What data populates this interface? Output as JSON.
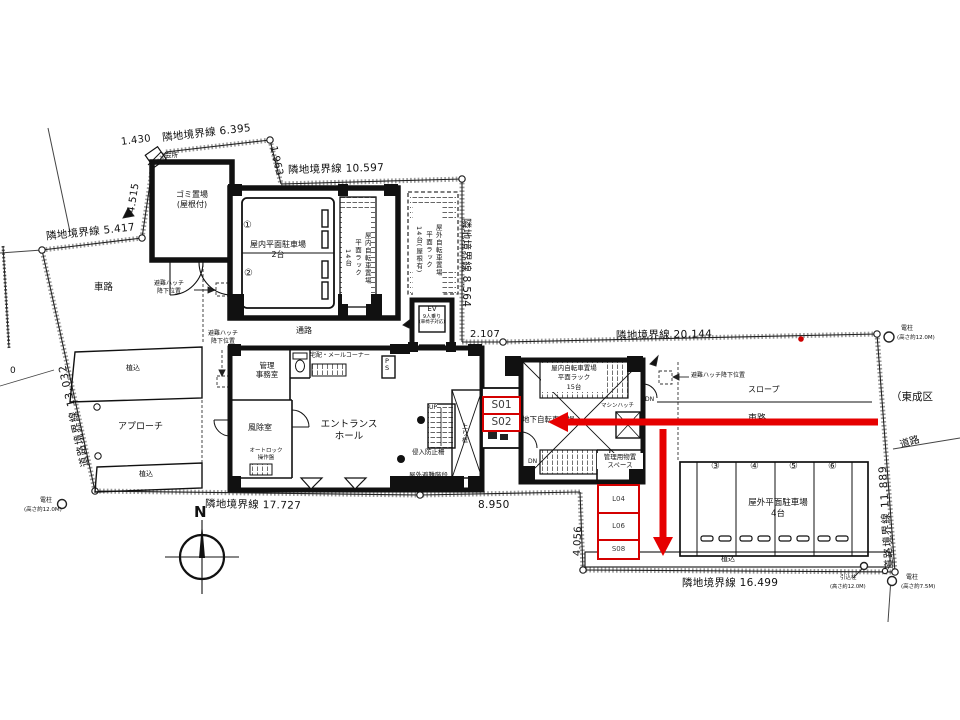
{
  "colors": {
    "red_arrow": "#e60000",
    "red_box": "#d40000",
    "ink": "#111111",
    "box_text": "#3a3a3a"
  },
  "boundary": {
    "b6395": "隣地境界線 6.395",
    "d1430": "1.430",
    "d1963": "1.963",
    "b10597": "隣地境界線 10.597",
    "b8564": "隣地境界線 8.564",
    "d2107": "2.107",
    "b20144": "隣地境界線 20.144",
    "b11889": "道路境界線 11.889",
    "b16499": "隣地境界線 16.499",
    "d4056": "4.056",
    "d8950": "8.950",
    "b17727": "隣地境界線 17.727",
    "b13032": "道路境界線 13.032",
    "b5417": "隣地境界線 5.417",
    "d4515": "4.515",
    "d0": "0"
  },
  "site": {
    "kaisho": "会所",
    "gomi1": "ゴミ置場",
    "gomi2": "(屋根付)",
    "sharo": "車路",
    "uekomi": "植込",
    "approach": "アプローチ",
    "tsuro": "通路",
    "slope": "スロープ",
    "road": "道路",
    "higashinari": "（東成区",
    "north": "N"
  },
  "rooms": {
    "p_in1": "屋内平面駐車場",
    "p_in2": "2台",
    "no1": "①",
    "no2": "②",
    "bike_in1": "屋内自転車置場",
    "bike_in2": "平面ラック",
    "bike_in3": "14台",
    "bike_out1": "屋外自転車置場",
    "bike_out2": "平面ラック",
    "bike_out3": "14台(屋根有)",
    "ev1": "EV",
    "ev2": "9人乗り",
    "ev3": "(車椅子対応)",
    "kanri1": "管理",
    "kanri2": "事務室",
    "takuhai": "宅配・メールコーナー",
    "ps": "PS",
    "fujo": "風除室",
    "auto1": "オートロック",
    "auto2": "操作盤",
    "ent1": "エントランス",
    "ent2": "ホール",
    "up": "UP",
    "dn": "DN",
    "agari": "上り框",
    "fence": "侵入防止柵",
    "esc": "屋外避難階段",
    "bike15_1": "屋内自転車置場",
    "bike15_2": "平面ラック",
    "bike15_3": "15台",
    "chika": "地下自転車置場",
    "mhatch": "マシンハッチ",
    "mono1": "管理用物置",
    "mono2": "スペース",
    "hatch1": "避難ハッチ",
    "hatch2": "降下位置",
    "hatch_full": "避難ハッチ降下位置",
    "p_out1": "屋外平面駐車場",
    "p_out2": "4台",
    "no3": "③",
    "no4": "④",
    "no5": "⑤",
    "no6": "⑥"
  },
  "poles": {
    "denchu": "電柱",
    "h12": "(高さ約12.0M)",
    "h7": "(高さ約7.5M)",
    "hikikomi": "引込柱"
  },
  "marks": {
    "s01": "S01",
    "s02": "S02",
    "l04": "L04",
    "l06": "L06",
    "s08": "S08"
  }
}
